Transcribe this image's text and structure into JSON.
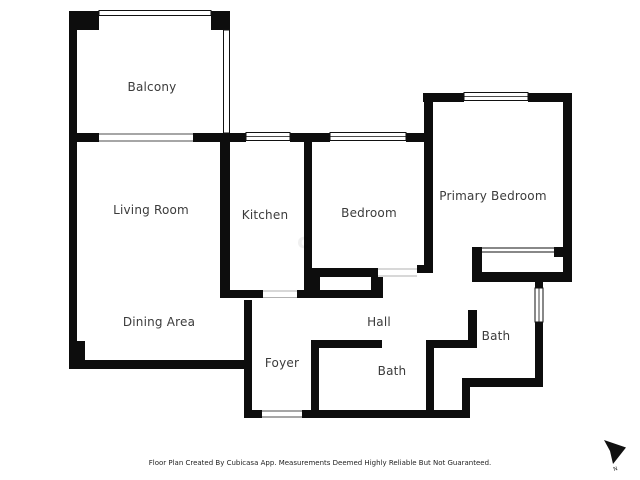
{
  "floor_plan": {
    "rooms": [
      {
        "id": "balcony",
        "label": "Balcony"
      },
      {
        "id": "living-room",
        "label": "Living Room"
      },
      {
        "id": "kitchen",
        "label": "Kitchen"
      },
      {
        "id": "bedroom",
        "label": "Bedroom"
      },
      {
        "id": "primary-bedroom",
        "label": "Primary Bedroom"
      },
      {
        "id": "dining-area",
        "label": "Dining Area"
      },
      {
        "id": "foyer",
        "label": "Foyer"
      },
      {
        "id": "hall",
        "label": "Hall"
      },
      {
        "id": "bath-lower",
        "label": "Bath"
      },
      {
        "id": "bath-right",
        "label": "Bath"
      }
    ],
    "colors": {
      "wall": "#0d0d0d",
      "label": "#3b3b3b",
      "background": "#ffffff"
    },
    "watermark": "c",
    "compass": {
      "label": "N"
    },
    "footer": {
      "disclaimer": "Floor Plan Created By Cubicasa App. Measurements Deemed Highly Reliable But Not Guaranteed."
    }
  }
}
